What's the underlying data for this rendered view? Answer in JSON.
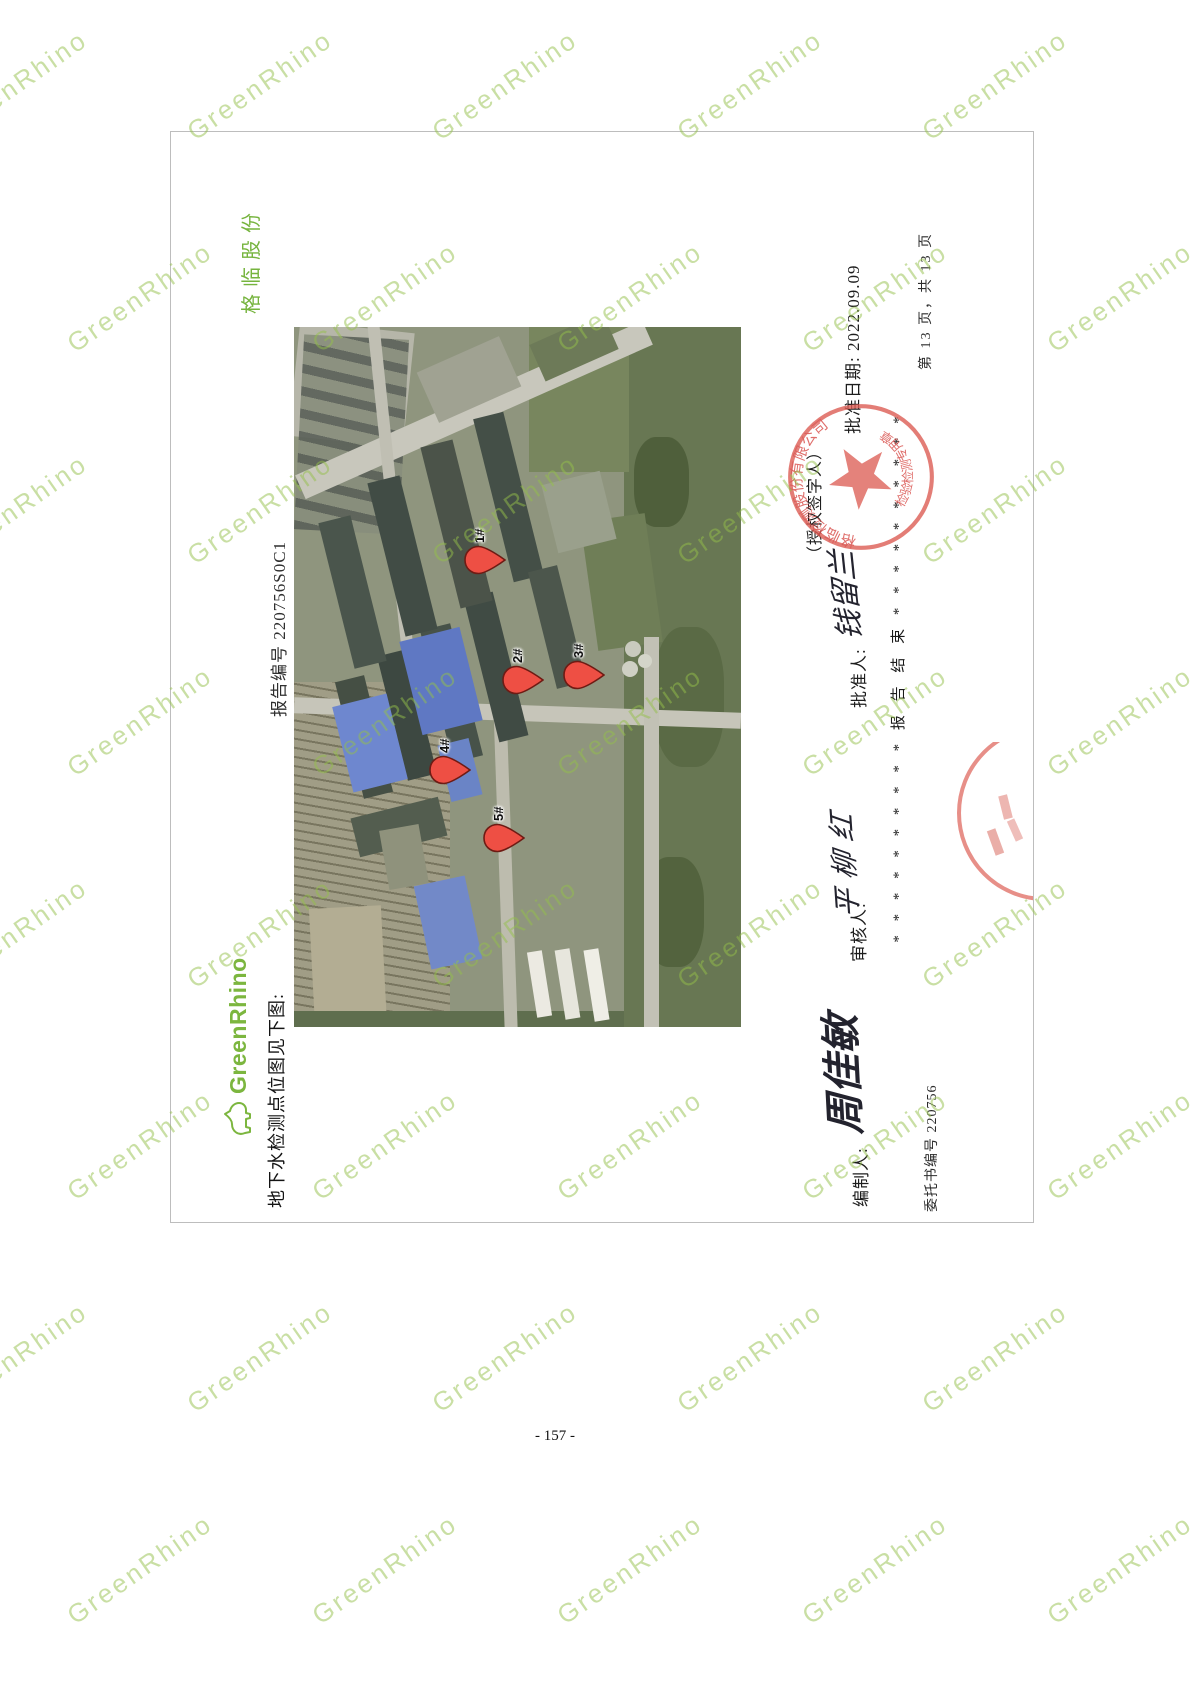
{
  "page": {
    "footer_page_number": "- 157 -"
  },
  "watermark": {
    "text": "GreenRhino",
    "color": "#94bf4a"
  },
  "header": {
    "logo_text": "GreenRhino",
    "map_caption": "地下水检测点位图见下图:",
    "report_no": "报告编号 220756S0C1",
    "brand": "格临股份"
  },
  "map": {
    "pins": [
      {
        "label": "1#",
        "x": 467,
        "y": 184
      },
      {
        "label": "2#",
        "x": 347,
        "y": 222
      },
      {
        "label": "3#",
        "x": 352,
        "y": 283
      },
      {
        "label": "4#",
        "x": 257,
        "y": 149
      },
      {
        "label": "5#",
        "x": 189,
        "y": 203
      }
    ]
  },
  "signoff": {
    "approve_date": "批准日期: 2022.09.09",
    "authorized_signer": "（授权签字人）",
    "approver_label": "批准人:",
    "approver_signature": "钱留兰",
    "reviewer_label": "审核人:",
    "reviewer_signature": "平柳红",
    "preparer_label": "编制人:",
    "preparer_signature": "周佳敏",
    "report_end_line": "*  *  *  *  *  *  *  *  *  *  报 告 结 束  *  *  *  *  *  *  *  *  *  *",
    "commission_no": "委托书编号 220756",
    "page_info": "第 13 页，共 13 页"
  },
  "seal": {
    "company_name": "格临检测股份有限公司",
    "bottom_text": "检验检测专用章",
    "color": "#d9534f"
  }
}
